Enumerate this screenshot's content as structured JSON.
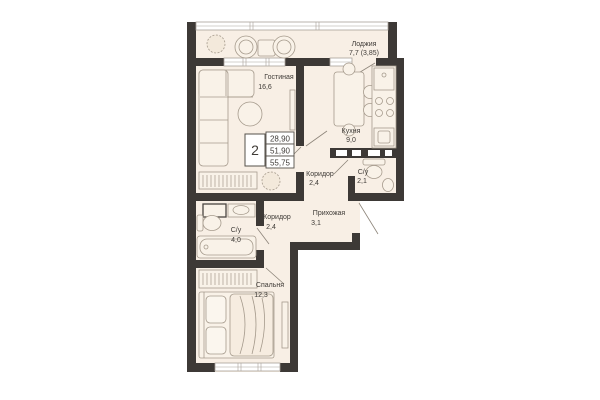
{
  "plan": {
    "title": "2-room apartment floor plan",
    "info_box": {
      "rooms_count": "2",
      "row1": "28,90",
      "row2": "51,90",
      "row3": "55,75"
    },
    "rooms": [
      {
        "id": "loggia",
        "label": "Лоджия",
        "area": "7,7 (3,85)"
      },
      {
        "id": "living",
        "label": "Гостиная",
        "area": "16,6"
      },
      {
        "id": "kitchen",
        "label": "Кухня",
        "area": "9,0"
      },
      {
        "id": "corridor-upper",
        "label": "Коридор",
        "area": "2,4"
      },
      {
        "id": "bath-small",
        "label": "С/у",
        "area": "2,1"
      },
      {
        "id": "hallway",
        "label": "Прихожая",
        "area": "3,1"
      },
      {
        "id": "corridor-lower",
        "label": "Коридор",
        "area": "2,4"
      },
      {
        "id": "bath-large",
        "label": "С/у",
        "area": "4,0"
      },
      {
        "id": "bedroom",
        "label": "Спальня",
        "area": "12,3"
      }
    ],
    "colors": {
      "wall": "#3d3936",
      "floor": "#f8efe5",
      "furniture_fill": "#f9f2e8",
      "furniture_stroke": "#a59a8c",
      "text": "#3f3b37"
    }
  }
}
